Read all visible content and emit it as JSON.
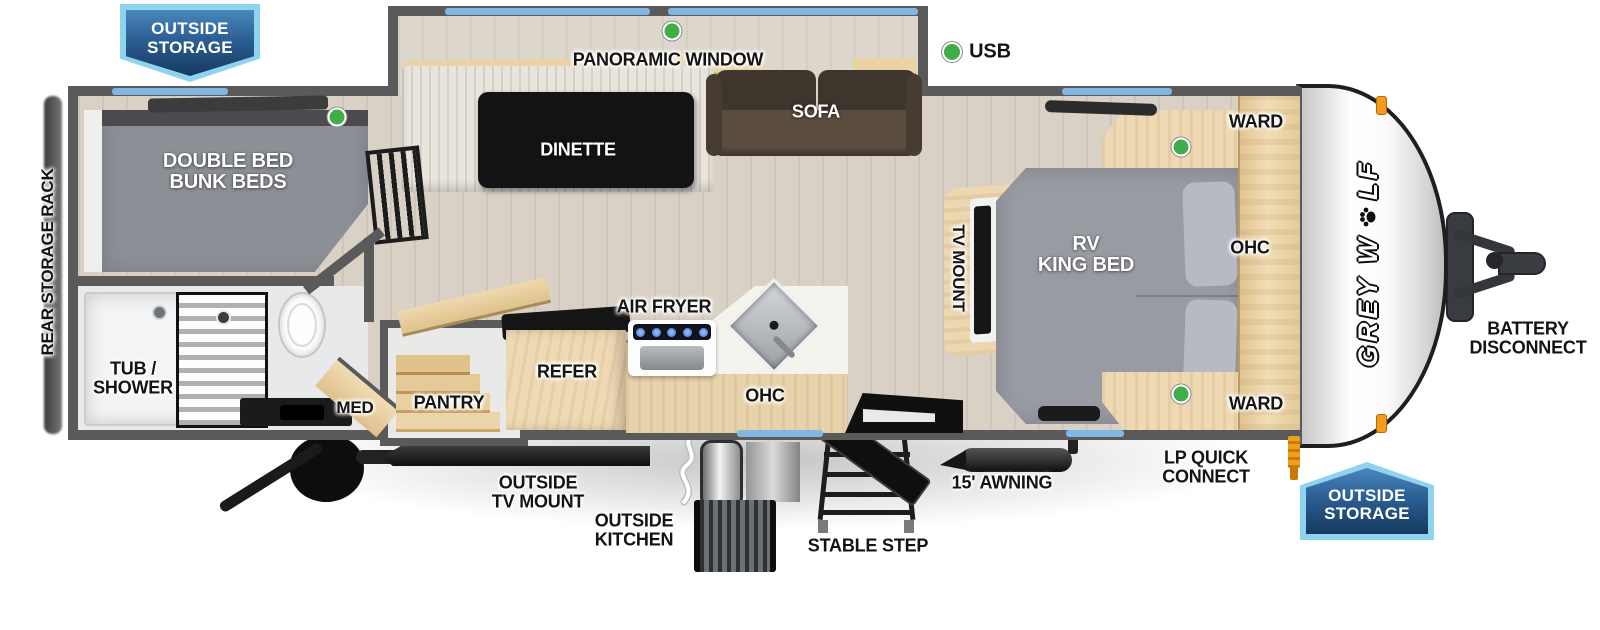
{
  "legend": {
    "usb": "USB"
  },
  "badges": {
    "top_left": {
      "line1": "OUTSIDE",
      "line2": "STORAGE"
    },
    "bottom_right": {
      "line1": "OUTSIDE",
      "line2": "STORAGE"
    }
  },
  "brand": {
    "prefix": "GREY W",
    "suffix": "LF"
  },
  "exterior": {
    "rear_storage_rack": "REAR STORAGE RACK",
    "battery": {
      "line1": "BATTERY",
      "line2": "DISCONNECT"
    },
    "outside_tv_mount": {
      "line1": "OUTSIDE",
      "line2": "TV MOUNT"
    },
    "outside_kitchen": {
      "line1": "OUTSIDE",
      "line2": "KITCHEN"
    },
    "stable_step": "STABLE STEP",
    "awning": "15' AWNING",
    "lp": {
      "line1": "LP QUICK",
      "line2": "CONNECT"
    }
  },
  "rooms": {
    "bunk": {
      "line1": "DOUBLE BED",
      "line2": "BUNK BEDS"
    },
    "panoramic_window": "PANORAMIC WINDOW",
    "dinette": "DINETTE",
    "sofa": "SOFA",
    "bath": {
      "tub1": "TUB /",
      "tub2": "SHOWER",
      "med": "MED"
    },
    "kitchen": {
      "pantry": "PANTRY",
      "refer": "REFER",
      "air_fryer": "AIR FRYER",
      "ohc": "OHC"
    },
    "bedroom": {
      "tv_mount": "TV MOUNT",
      "bed1": "RV",
      "bed2": "KING BED",
      "ward_top": "WARD",
      "ohc": "OHC",
      "ward_bottom": "WARD"
    }
  },
  "colors": {
    "wall_gray": "#5a5a5a",
    "window_blue": "#82b7e4",
    "usb_green": "#3fae49",
    "badge_blue": "#2c5f93",
    "badge_border": "#8fd4ef",
    "wood": "#ecd7b1",
    "floor": "#d9d1c6",
    "bed_gray": "#999ba3",
    "clearance_orange": "#f59a1f"
  }
}
